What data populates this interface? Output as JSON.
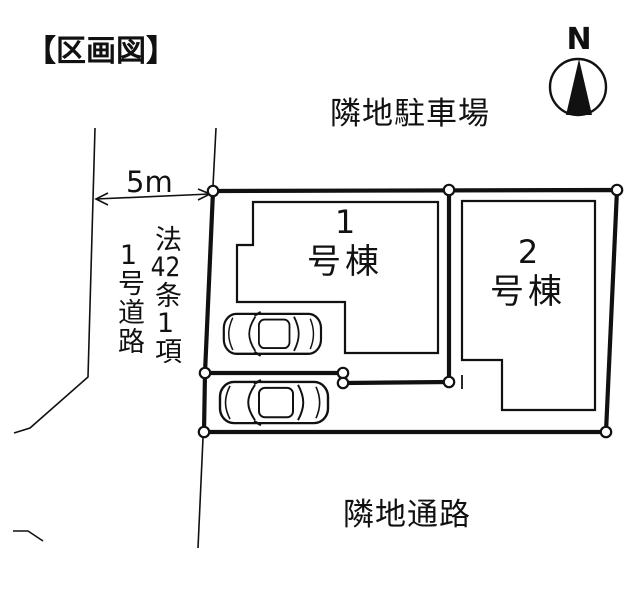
{
  "title": "【区画図】",
  "compass": {
    "label": "N"
  },
  "labels": {
    "neighbor_top": "隣地駐車場",
    "neighbor_bottom": "隣地通路",
    "road_width": "5m"
  },
  "road_name": {
    "col1": {
      "p1": "法",
      "p2": "42",
      "p3": "条",
      "p4": "1",
      "p5": "項"
    },
    "col2": {
      "p1": "1",
      "p2": "号道路"
    }
  },
  "buildings": {
    "b1": {
      "number": "1",
      "suffix": "号棟"
    },
    "b2": {
      "number": "2",
      "suffix": "号棟"
    }
  },
  "colors": {
    "ink": "#111111",
    "background": "#ffffff"
  }
}
